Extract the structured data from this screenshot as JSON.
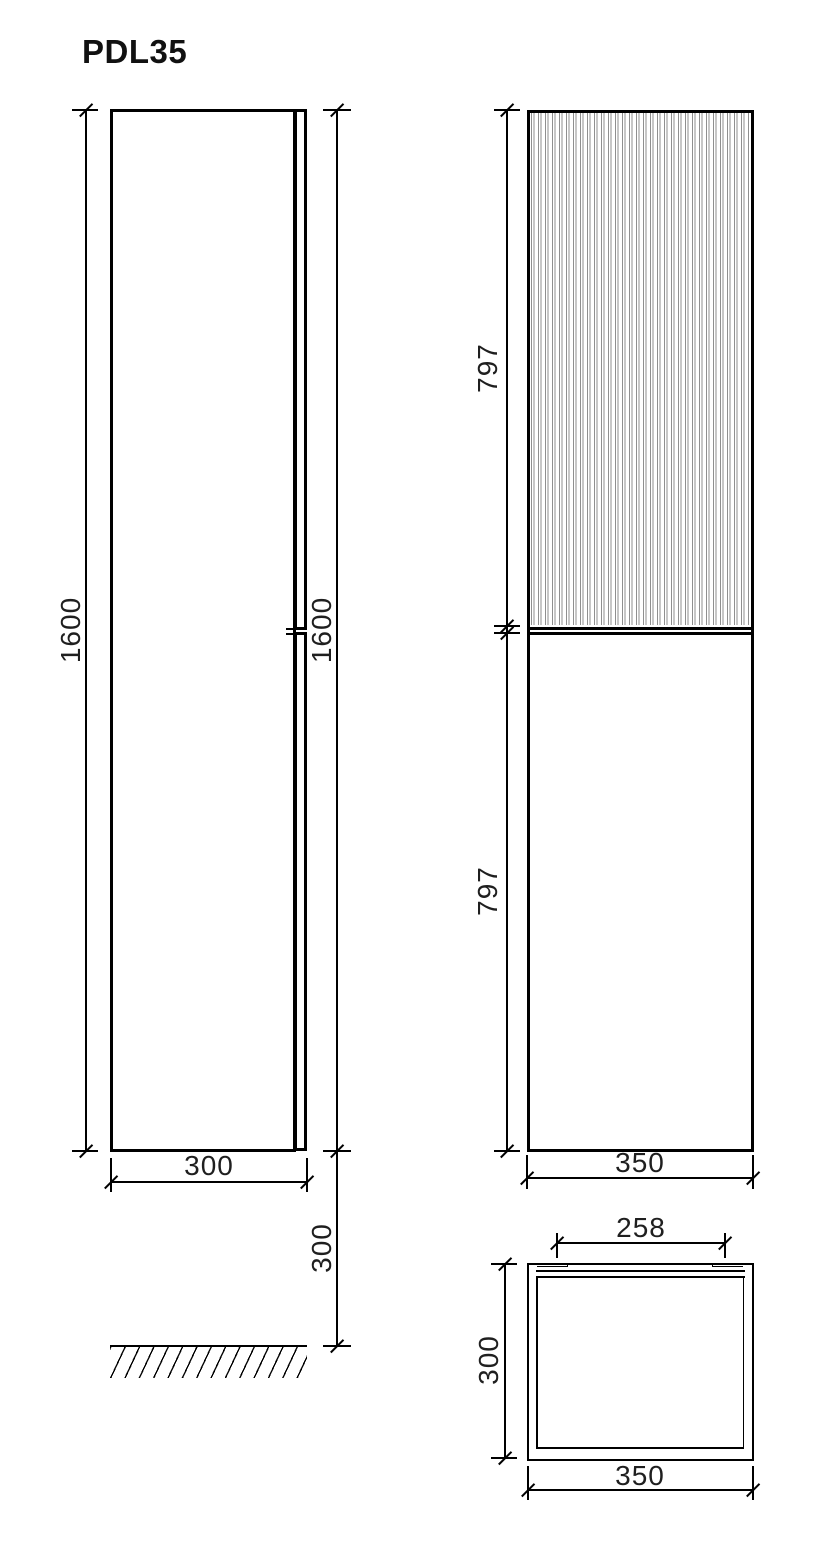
{
  "title": "PDL35",
  "dimensions": {
    "side_height_left": "1600",
    "side_height_right": "1600",
    "side_depth": "300",
    "side_floor_offset": "300",
    "front_upper_door_height": "797",
    "front_lower_door_height": "797",
    "front_width": "350",
    "plan_inner_width": "258",
    "plan_depth": "300",
    "plan_width": "350"
  },
  "colors": {
    "line": "#000000",
    "flute_stripe": "#8f8f8f",
    "text": "#1f1f1f",
    "background": "#ffffff"
  }
}
